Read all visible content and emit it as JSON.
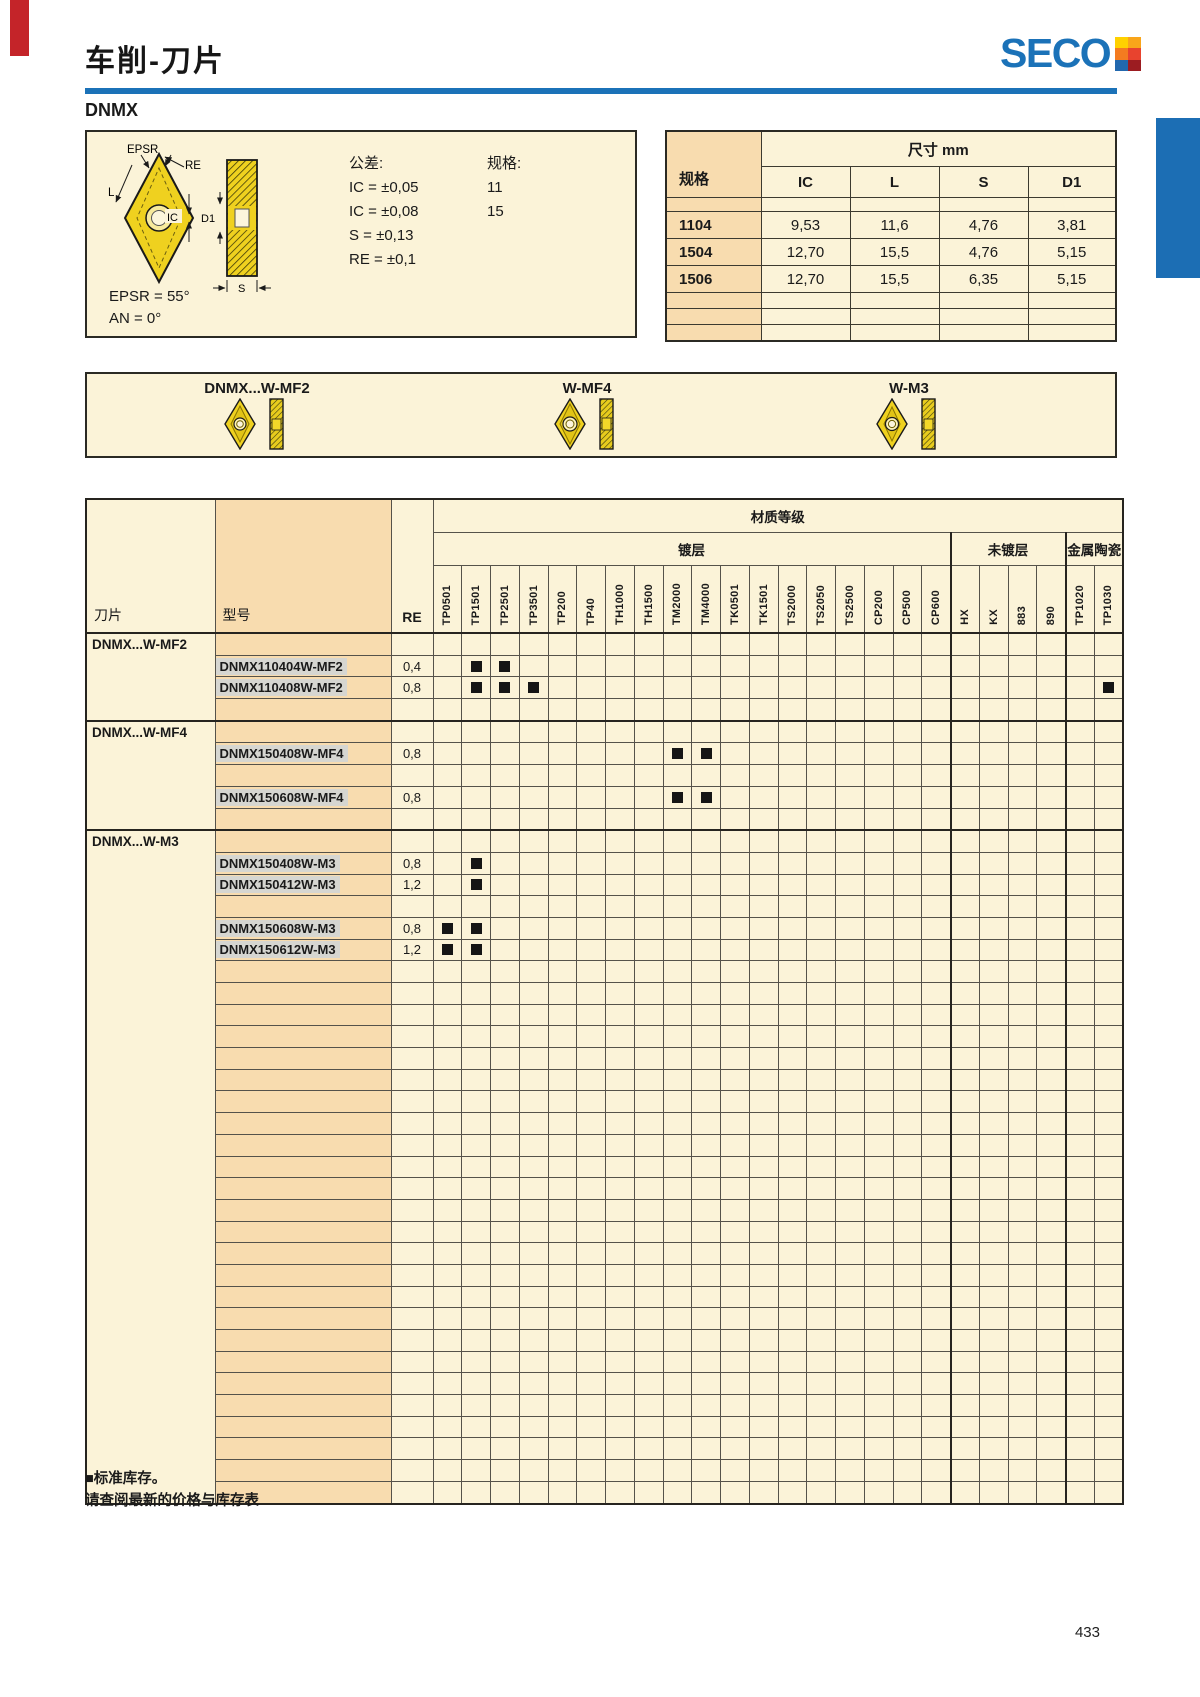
{
  "page": {
    "title": "车削-刀片",
    "family": "DNMX",
    "page_number": "433"
  },
  "logo": {
    "text": "SECO"
  },
  "colors": {
    "accent_blue": "#1B72B8",
    "tab_red": "#C42429",
    "cream": "#FBF3D8",
    "peach": "#F8DCAF",
    "insert_yellow": "#EFD11F",
    "stock_mark": "#151515"
  },
  "spec_box": {
    "tolerance_title": "公差:",
    "tolerances": [
      "IC = ±0,05",
      "IC = ±0,08",
      "S = ±0,13",
      "RE = ±0,1"
    ],
    "size_title": "规格:",
    "sizes": [
      "11",
      "15"
    ],
    "angle_notes": [
      "EPSR = 55°",
      "AN = 0°"
    ],
    "diagram_labels": {
      "epsr": "EPSR",
      "re": "RE",
      "l": "L",
      "ic": "IC",
      "d1": "D1",
      "s": "S"
    }
  },
  "dim_table": {
    "col_header": "规格",
    "span_header": "尺寸 mm",
    "columns": [
      "IC",
      "L",
      "S",
      "D1"
    ],
    "rows": [
      {
        "spec": "1104",
        "values": [
          "9,53",
          "11,6",
          "4,76",
          "3,81"
        ]
      },
      {
        "spec": "1504",
        "values": [
          "12,70",
          "15,5",
          "4,76",
          "5,15"
        ]
      },
      {
        "spec": "1506",
        "values": [
          "12,70",
          "15,5",
          "6,35",
          "5,15"
        ]
      }
    ]
  },
  "insert_gallery": {
    "items": [
      {
        "label": "DNMX...W-MF2"
      },
      {
        "label": "W-MF4"
      },
      {
        "label": "W-M3"
      }
    ]
  },
  "grades_table": {
    "title": "材质等级",
    "groups": [
      {
        "label": "镀层",
        "span": 18
      },
      {
        "label": "未镀层",
        "span": 4
      },
      {
        "label": "金属陶瓷",
        "span": 2
      }
    ],
    "corner_headers": {
      "insert": "刀片",
      "model": "型号",
      "re": "RE"
    },
    "grade_columns": [
      "TP0501",
      "TP1501",
      "TP2501",
      "TP3501",
      "TP200",
      "TP40",
      "TH1000",
      "TH1500",
      "TM2000",
      "TM4000",
      "TK0501",
      "TK1501",
      "TS2000",
      "TS2050",
      "TS2500",
      "CP200",
      "CP500",
      "CP600",
      "HX",
      "KX",
      "883",
      "890",
      "TP1020",
      "TP1030"
    ],
    "stock_mark_glyph": "■",
    "rows": [
      {
        "type": "group",
        "label": "DNMX...W-MF2"
      },
      {
        "type": "model",
        "model": "DNMX110404W-MF2",
        "re": "0,4",
        "marks": [
          "TP1501",
          "TP2501"
        ]
      },
      {
        "type": "model",
        "model": "DNMX110408W-MF2",
        "re": "0,8",
        "marks": [
          "TP1501",
          "TP2501",
          "TP3501",
          "TP1030"
        ]
      },
      {
        "type": "empty"
      },
      {
        "type": "group",
        "label": "DNMX...W-MF4"
      },
      {
        "type": "model",
        "model": "DNMX150408W-MF4",
        "re": "0,8",
        "marks": [
          "TM2000",
          "TM4000"
        ]
      },
      {
        "type": "empty"
      },
      {
        "type": "model",
        "model": "DNMX150608W-MF4",
        "re": "0,8",
        "marks": [
          "TM2000",
          "TM4000"
        ]
      },
      {
        "type": "empty"
      },
      {
        "type": "group",
        "label": "DNMX...W-M3"
      },
      {
        "type": "model",
        "model": "DNMX150408W-M3",
        "re": "0,8",
        "marks": [
          "TP1501"
        ]
      },
      {
        "type": "model",
        "model": "DNMX150412W-M3",
        "re": "1,2",
        "marks": [
          "TP1501"
        ]
      },
      {
        "type": "empty"
      },
      {
        "type": "model",
        "model": "DNMX150608W-M3",
        "re": "0,8",
        "marks": [
          "TP0501",
          "TP1501"
        ]
      },
      {
        "type": "model",
        "model": "DNMX150612W-M3",
        "re": "1,2",
        "marks": [
          "TP0501",
          "TP1501"
        ]
      },
      {
        "type": "empty"
      },
      {
        "type": "empty"
      },
      {
        "type": "empty"
      },
      {
        "type": "empty"
      },
      {
        "type": "empty"
      },
      {
        "type": "empty"
      },
      {
        "type": "empty"
      },
      {
        "type": "empty"
      },
      {
        "type": "empty"
      },
      {
        "type": "empty"
      },
      {
        "type": "empty"
      },
      {
        "type": "empty"
      },
      {
        "type": "empty"
      },
      {
        "type": "empty"
      },
      {
        "type": "empty"
      },
      {
        "type": "empty"
      },
      {
        "type": "empty"
      },
      {
        "type": "empty"
      },
      {
        "type": "empty"
      },
      {
        "type": "empty"
      },
      {
        "type": "empty"
      },
      {
        "type": "empty"
      },
      {
        "type": "empty"
      },
      {
        "type": "empty"
      },
      {
        "type": "empty"
      }
    ]
  },
  "footer": {
    "line1": "■标准库存。",
    "line2": "请查阅最新的价格与库存表"
  }
}
